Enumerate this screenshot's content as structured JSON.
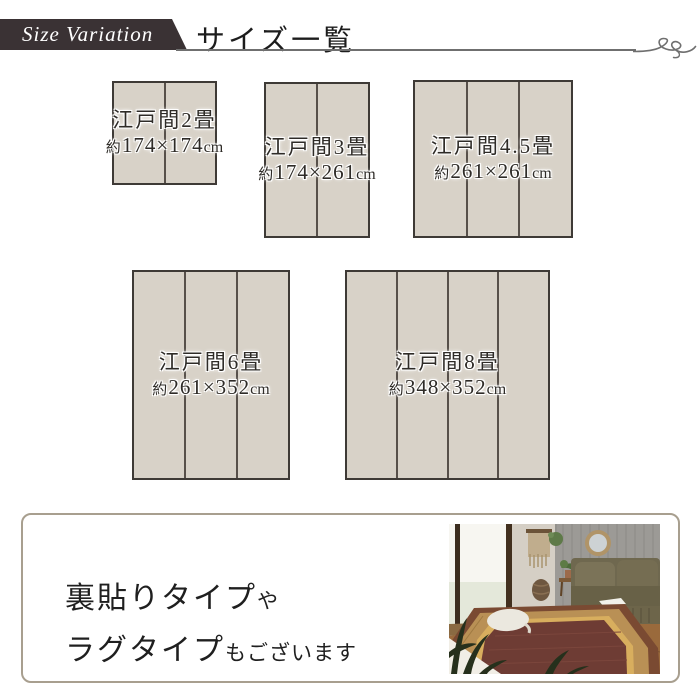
{
  "header": {
    "badge_label": "Size Variation",
    "title": "サイズ一覧"
  },
  "sizes": [
    {
      "name": "江戸間2畳",
      "size_prefix": "約",
      "size_value": "174×174",
      "size_unit": "cm",
      "sections": 2
    },
    {
      "name": "江戸間3畳",
      "size_prefix": "約",
      "size_value": "174×261",
      "size_unit": "cm",
      "sections": 2
    },
    {
      "name": "江戸間4.5畳",
      "size_prefix": "約",
      "size_value": "261×261",
      "size_unit": "cm",
      "sections": 3
    },
    {
      "name": "江戸間6畳",
      "size_prefix": "約",
      "size_value": "261×352",
      "size_unit": "cm",
      "sections": 3
    },
    {
      "name": "江戸間8畳",
      "size_prefix": "約",
      "size_value": "348×352",
      "size_unit": "cm",
      "sections": 4
    }
  ],
  "note": {
    "line1_main": "裏貼りタイプ",
    "line1_small": "や",
    "line2_main": "ラグタイプ",
    "line2_small": "もございます"
  },
  "colors": {
    "banner_bg": "#3a3234",
    "mat_fill": "#d8d2c8",
    "mat_border": "#3e3a36",
    "mat_divider": "#57504a",
    "header_rule": "#6f6f6f",
    "note_box_border": "#a89f8f",
    "rug_red": "#6e3c34",
    "rug_tan": "#b99055",
    "rug_gold": "#d8ae5e",
    "sofa_olive": "#6f684f"
  }
}
